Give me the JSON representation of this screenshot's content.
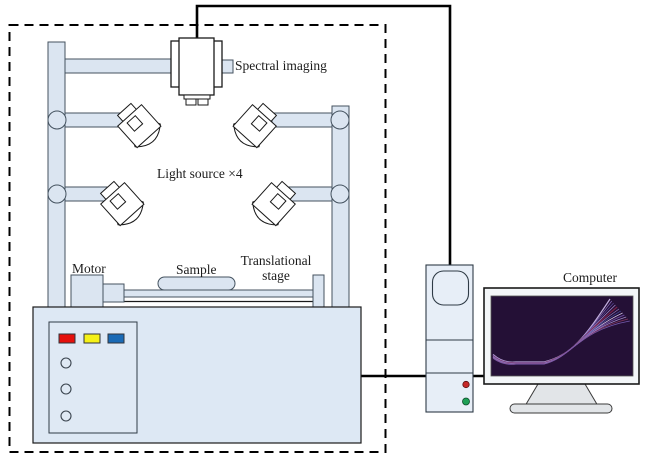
{
  "labels": {
    "spectral_imaging": "Spectral imaging",
    "light_source": "Light source ×4",
    "motor": "Motor",
    "sample": "Sample",
    "translational_stage": "Translational stage",
    "computer": "Computer"
  },
  "colors": {
    "structure_fill": "#dbe5f1",
    "structure_stroke": "#44525f",
    "device_fill": "#ffffff",
    "outline": "#1a1a1a",
    "cable": "#000000",
    "table_fill": "#dde8f4",
    "panel_fill": "#dfe9f4",
    "tower_fill": "#e7eef7",
    "button_red": "#e5100c",
    "button_yellow": "#f5f117",
    "button_blue": "#1a6ab5",
    "led_red": "#c62828",
    "led_green": "#1fa056",
    "screen_bg": "#241036",
    "monitor_frame": "#f3f6f8",
    "monitor_stroke": "#1a1a1a",
    "stand_fill": "#e2e5e8",
    "label_color": "#1c1c1c"
  },
  "screen_curves": {
    "colors": [
      "#cbb8e8",
      "#8b6fc0",
      "#5c4a9e",
      "#b090d8",
      "#7a2048",
      "#9b7fc4",
      "#4a5ab0",
      "#d8c8f0",
      "#6a4a9c",
      "#a98fd0",
      "#8b3a62",
      "#7a5fb5"
    ]
  }
}
